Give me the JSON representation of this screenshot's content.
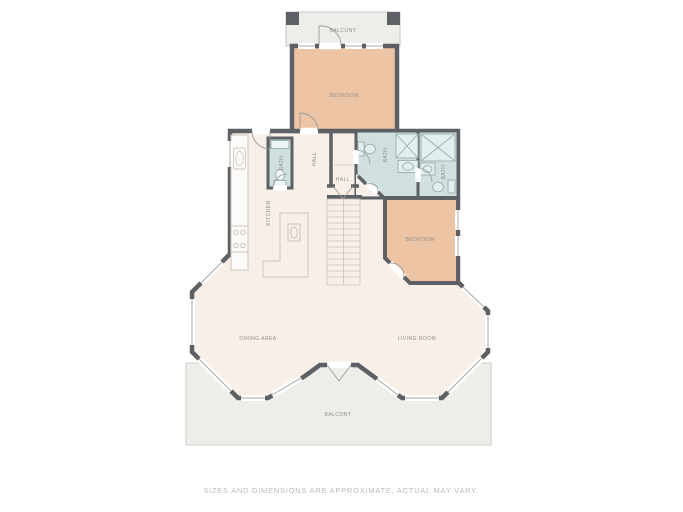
{
  "plan": {
    "rooms": {
      "balcony_top": "BALCONY",
      "bedroom_top": "BEDROOM",
      "bath_1": "BATH",
      "hall_vertical": "HALL",
      "hall": "HALL",
      "kitchen": "KITCHEN",
      "bath_2": "BATH",
      "bath_3": "BATH",
      "bedroom_right": "BEDROOM",
      "dining_area": "DINING AREA",
      "living_room": "LIVING ROOM",
      "balcony_bottom": "BALCONY"
    },
    "colors": {
      "wall": "#5d6165",
      "floor": "#f8efe9",
      "bedroom_floor": "#edc5a5",
      "bath_floor": "#cfe0df",
      "balcony_floor": "#ededea",
      "label_text": "#8f8f8c",
      "disclaimer_text": "#b9bbbd"
    }
  },
  "footer": {
    "disclaimer": "SIZES AND DIMENSIONS ARE APPROXIMATE, ACTUAL MAY VARY."
  }
}
